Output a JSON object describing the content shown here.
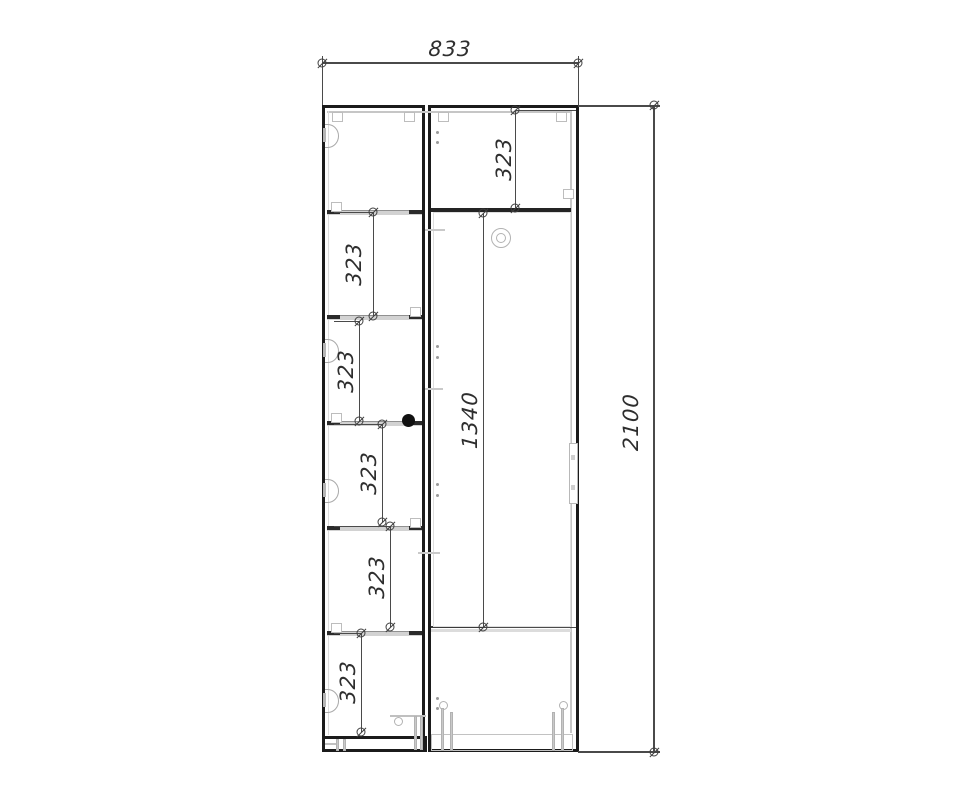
{
  "drawing": {
    "type": "cabinet-front-elevation",
    "units": "mm",
    "dimensions": {
      "overall_width": "833",
      "overall_height": "2100",
      "right_door_height": "1340",
      "top_right_section_height": "323",
      "left_shelf_spacings": [
        "323",
        "323",
        "323",
        "323",
        "323"
      ]
    },
    "colors": {
      "background": "#ffffff",
      "outline": "#1b1b1b",
      "panel_light": "#c6c6c6",
      "dimension_line": "#4a4a4a",
      "text": "#2e2e2e"
    },
    "symbols": [
      "hinge-icon",
      "door-knob",
      "lock-knob",
      "door-handle",
      "adjustable-foot",
      "dimension-marker",
      "shelf-bracket"
    ]
  }
}
